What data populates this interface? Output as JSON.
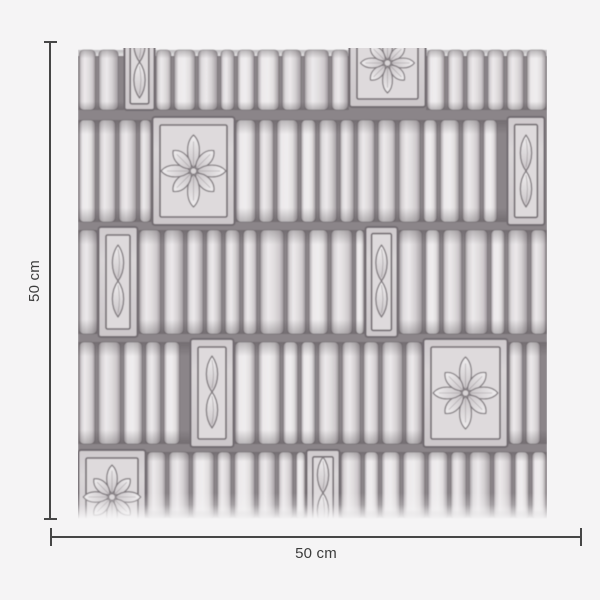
{
  "figure": {
    "background": "#f5f4f5",
    "line_color": "#464646",
    "text_color": "#3c3c3c",
    "width_label": "50 cm",
    "height_label": "50 cm"
  },
  "swatch": {
    "description": "hand-drawn grayscale ribbed tile wallpaper pattern with flower and lens motif panels",
    "x": 78,
    "y": 48,
    "width": 469,
    "height": 471,
    "seed": 12,
    "tile_gap": 3.4,
    "palette": {
      "backing": "#8b8589",
      "frame": "#716b6f",
      "tile_edge": "#9f999d",
      "tile_light": "#ece9eb",
      "tile_mid": "#e0ddde",
      "panel_fill": "#dad6d8",
      "panel_inner": "#dedadc",
      "motif_light": "#f0eeef",
      "motif_dark": "#c8c3c6",
      "motif_stroke": "#7d777b",
      "shade": "rgba(60,54,58,0.30)",
      "fade": "245,244,245"
    },
    "rows": [
      {
        "y0": 2,
        "y1": 62,
        "panels": [
          {
            "type": "lens",
            "x": 46,
            "w": 31,
            "py0": -46,
            "py1": 62,
            "cy": 14
          },
          {
            "type": "flower",
            "x": 271,
            "w": 77,
            "py0": -44,
            "py1": 59,
            "cy": 15,
            "r": 30
          }
        ]
      },
      {
        "y0": 72,
        "y1": 174,
        "panels": [
          {
            "type": "flower",
            "x": 74,
            "w": 83,
            "cy": 123,
            "r": 36
          },
          {
            "type": "lens",
            "x": 429,
            "w": 38,
            "cy": 123
          }
        ]
      },
      {
        "y0": 182,
        "y1": 286,
        "panels": [
          {
            "type": "lens",
            "x": 20,
            "w": 40,
            "cy": 233
          },
          {
            "type": "lens",
            "x": 287,
            "w": 33,
            "cy": 233
          }
        ]
      },
      {
        "y0": 294,
        "y1": 396,
        "panels": [
          {
            "type": "lens",
            "x": 112,
            "w": 44,
            "cy": 344
          },
          {
            "type": "flower",
            "x": 345,
            "w": 85,
            "cy": 345,
            "r": 36
          }
        ]
      },
      {
        "y0": 404,
        "y1": 471,
        "panels": [
          {
            "type": "flower",
            "x": 0,
            "w": 68,
            "py0": 402,
            "py1": 486,
            "cy": 449,
            "r": 32
          },
          {
            "type": "lens",
            "x": 228,
            "w": 34,
            "py0": 402,
            "py1": 482,
            "cy": 445
          }
        ]
      }
    ]
  },
  "dimensions": {
    "vertical": {
      "x": 49,
      "y0": 41,
      "y1": 520
    },
    "horizontal": {
      "y": 536,
      "x0": 50,
      "x1": 582
    }
  }
}
